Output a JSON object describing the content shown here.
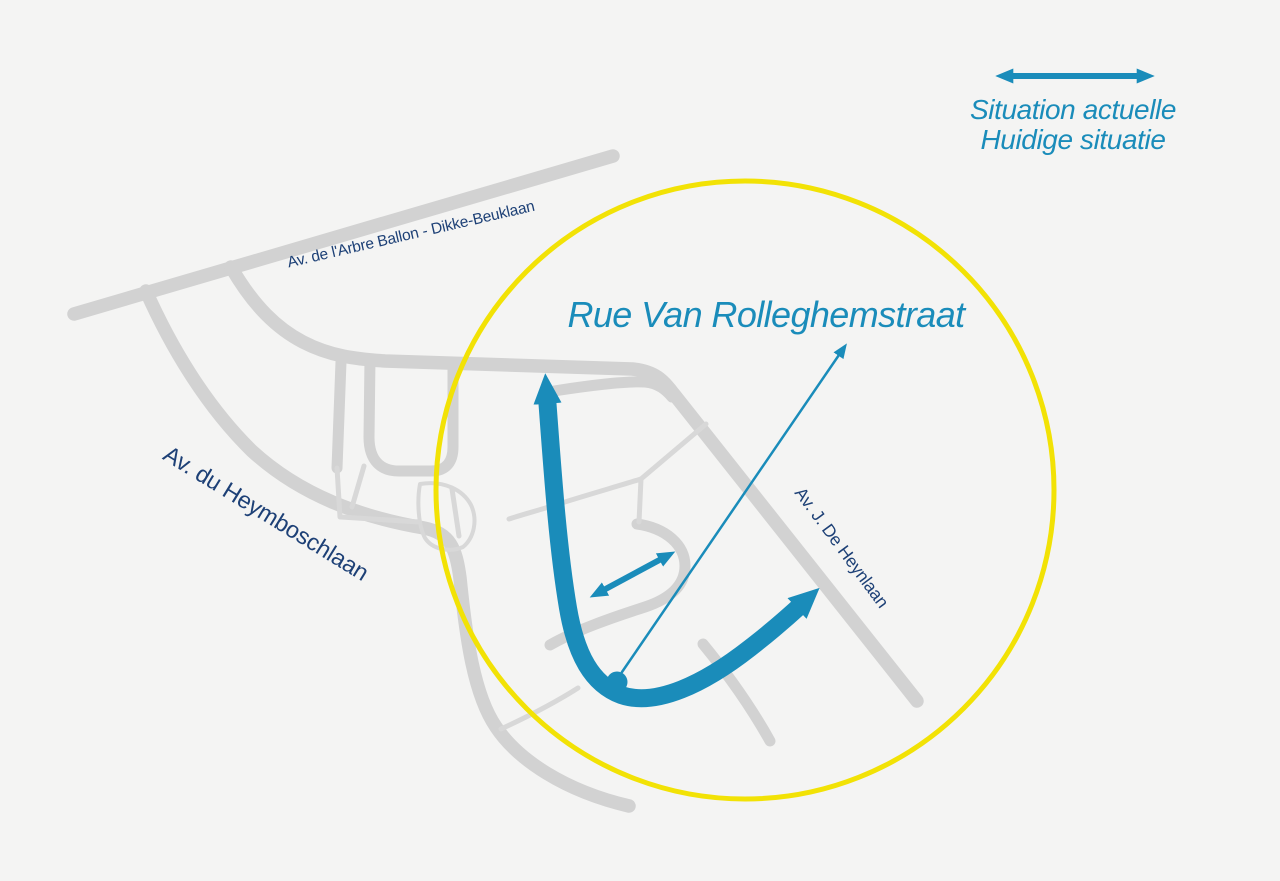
{
  "legend": {
    "symbol_icon": "double-headed-arrow-icon",
    "line1": "Situation actuelle",
    "line2": "Huidige situatie"
  },
  "map": {
    "street_labels": [
      {
        "id": "arbre-ballon",
        "text": "Av. de l'Arbre Ballon - Dikke-Beuklaan"
      },
      {
        "id": "heymboschlaan",
        "text": "Av. du Heymboschlaan"
      },
      {
        "id": "rolleghemstraat",
        "text": "Rue Van Rolleghemstraat"
      },
      {
        "id": "heynlaan",
        "text": "Av. J. De Heynlaan"
      }
    ],
    "annotations": {
      "highlight": "yellow-circle-highlight",
      "main_flow": "thick-double-ended-traffic-arrow",
      "secondary_flow": "small-double-ended-traffic-arrow",
      "label_leader": "dot-and-arrow-leader-line"
    }
  },
  "colors": {
    "teal": "#1a8cba",
    "navy": "#1d4076",
    "yellow": "#f2e205",
    "road_gray": "#d2d2d2",
    "road_gray_light": "#d8d8d8",
    "background": "#f4f4f3"
  }
}
